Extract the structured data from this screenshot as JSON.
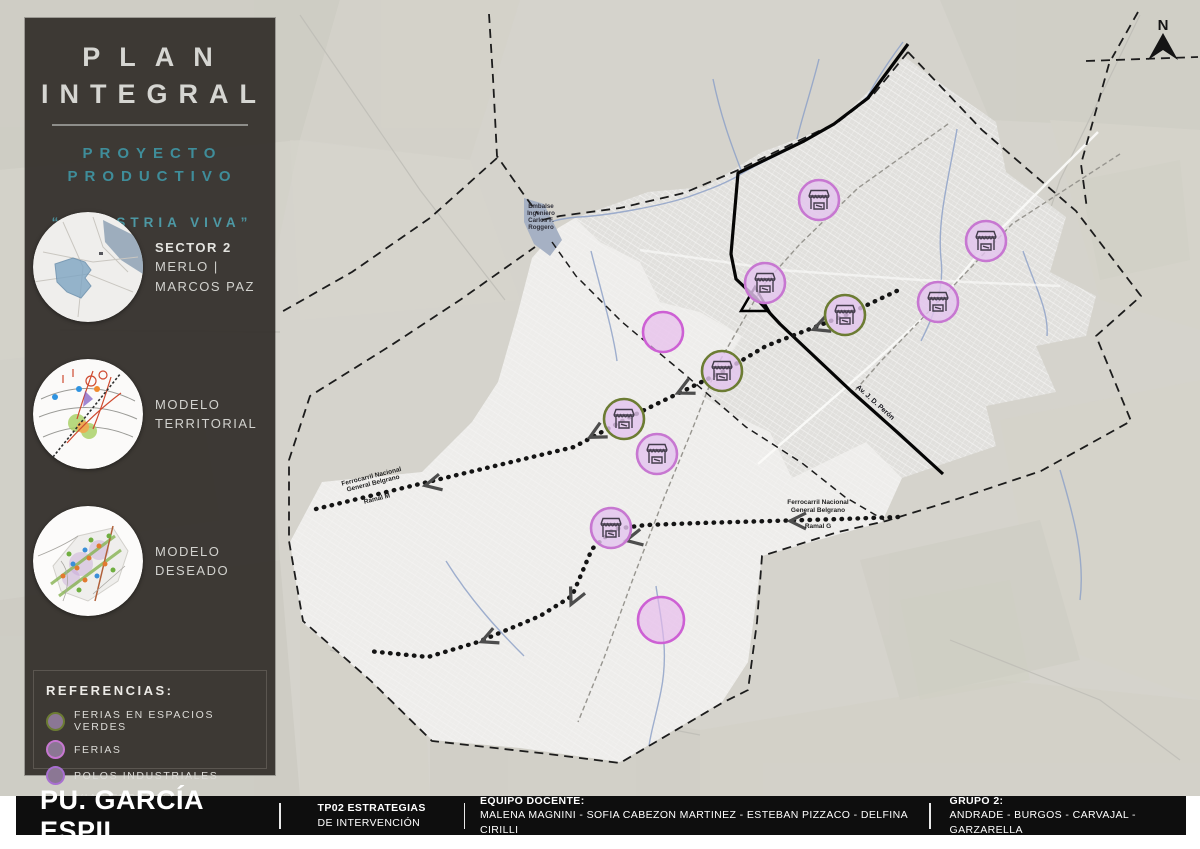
{
  "colors": {
    "accent_teal": "#3f8d9a",
    "sidebar_bg": "#383430",
    "footer_bg": "#0e0e0e",
    "feria_fill": "#e3c4ee",
    "feria_border_pink": "#c777d1",
    "feria_border_green": "#6c7c33",
    "polo_fill": "#e7b9ec",
    "polo_border": "#cd60d4"
  },
  "sidebar": {
    "title_line1": "PLAN",
    "title_line2": "INTEGRAL",
    "subtitle_line1": "PROYECTO",
    "subtitle_line2": "PRODUCTIVO",
    "quote": "“INDUSTRIA VIVA”",
    "thumbnails": [
      {
        "label_line1": "SECTOR 2",
        "label_line2": "MERLO | MARCOS PAZ"
      },
      {
        "label_line1": "MODELO",
        "label_line2": "TERRITORIAL"
      },
      {
        "label_line1": "MODELO",
        "label_line2": "DESEADO"
      }
    ],
    "legend": {
      "title": "REFERENCIAS:",
      "items": [
        {
          "label": "FERIAS EN ESPACIOS VERDES",
          "swatch": "circle",
          "border": "#6c7c33"
        },
        {
          "label": "FERIAS",
          "swatch": "circle",
          "border": "#c777d1"
        },
        {
          "label": "POLOS INDUSTRIALES",
          "swatch": "circle",
          "border": "#a86fd0"
        },
        {
          "label": "VIAS FERREAS REACTIVADAS",
          "swatch": "dashed-rect",
          "border": "#111111"
        }
      ]
    }
  },
  "map": {
    "north_label": "N",
    "water_label_lines": [
      "Embalse",
      "Ingeniero",
      "Carlos F.",
      "Roggero"
    ],
    "rail_labels": [
      {
        "line1": "Ferrocarril Nacional",
        "line2": "General Belgrano",
        "line3": "Ramal M"
      },
      {
        "line1": "Ferrocarril Nacional",
        "line2": "General Belgrano",
        "line3": "Ramal G"
      }
    ],
    "road_label": "Av. J. D. Perón",
    "markers": [
      {
        "x": 819,
        "y": 200,
        "type": "feria"
      },
      {
        "x": 986,
        "y": 241,
        "type": "feria"
      },
      {
        "x": 765,
        "y": 283,
        "type": "feria"
      },
      {
        "x": 845,
        "y": 315,
        "type": "feria_verde"
      },
      {
        "x": 938,
        "y": 302,
        "type": "feria"
      },
      {
        "x": 722,
        "y": 371,
        "type": "feria_verde"
      },
      {
        "x": 624,
        "y": 419,
        "type": "feria_verde"
      },
      {
        "x": 657,
        "y": 454,
        "type": "feria"
      },
      {
        "x": 611,
        "y": 528,
        "type": "feria"
      }
    ],
    "polos": [
      {
        "x": 663,
        "y": 332,
        "r": 20
      },
      {
        "x": 661,
        "y": 620,
        "r": 23
      }
    ]
  },
  "footer": {
    "title": "PU. GARCÍA ESPIL",
    "sections": [
      {
        "line1": "TP02 ESTRATEGIAS",
        "line2": "DE INTERVENCIÓN"
      },
      {
        "line1": "EQUIPO DOCENTE:",
        "line2": "MALENA MAGNINI - SOFIA CABEZON MARTINEZ - ESTEBAN PIZZACO - DELFINA CIRILLI"
      },
      {
        "line1": "GRUPO 2:",
        "line2": "ANDRADE - BURGOS - CARVAJAL - GARZARELLA"
      }
    ]
  }
}
